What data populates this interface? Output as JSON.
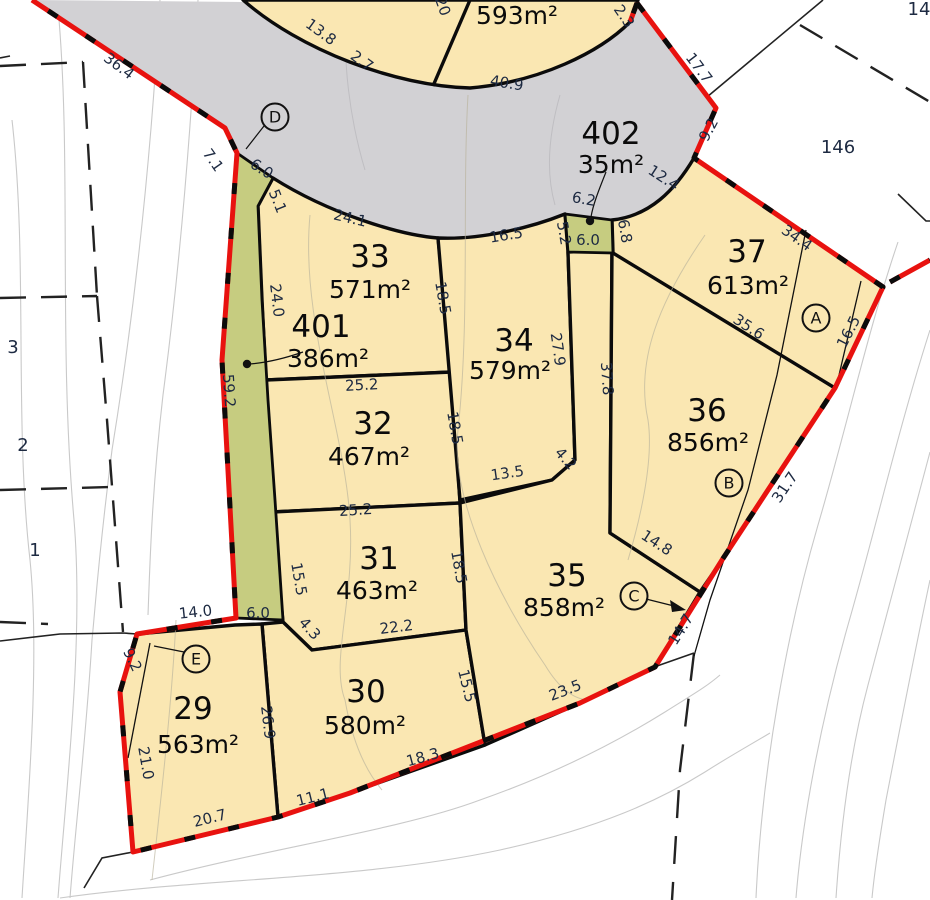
{
  "map_type": "cadastral subdivision survey plan",
  "colors": {
    "lot_fill": "#FAE7B2",
    "road_fill": "#D2D1D4",
    "reserve_fill": "#C6CC80",
    "boundary_red": "#E8120F",
    "line_black": "#0B0B0B",
    "contour_gray": "#C9C9C9",
    "dim_text": "#1D2A42"
  },
  "lots": [
    {
      "id": "33",
      "area": "571m²",
      "nx": 370,
      "ny": 267,
      "ax": 370,
      "ay": 298
    },
    {
      "id": "401",
      "area": "386m²",
      "nx": 321,
      "ny": 337,
      "ax": 328,
      "ay": 367
    },
    {
      "id": "32",
      "area": "467m²",
      "nx": 373,
      "ny": 434,
      "ax": 369,
      "ay": 465
    },
    {
      "id": "34",
      "area": "579m²",
      "nx": 514,
      "ny": 351,
      "ax": 510,
      "ay": 379
    },
    {
      "id": "31",
      "area": "463m²",
      "nx": 379,
      "ny": 569,
      "ax": 377,
      "ay": 599
    },
    {
      "id": "35",
      "area": "858m²",
      "nx": 567,
      "ny": 586,
      "ax": 564,
      "ay": 616
    },
    {
      "id": "36",
      "area": "856m²",
      "nx": 707,
      "ny": 421,
      "ax": 708,
      "ay": 451
    },
    {
      "id": "37",
      "area": "613m²",
      "nx": 747,
      "ny": 262,
      "ax": 748,
      "ay": 294
    },
    {
      "id": "30",
      "area": "580m²",
      "nx": 366,
      "ny": 702,
      "ax": 365,
      "ay": 734
    },
    {
      "id": "29",
      "area": "563m²",
      "nx": 193,
      "ny": 719,
      "ax": 198,
      "ay": 753
    },
    {
      "id": "402",
      "area": "35m²",
      "nx": 611,
      "ny": 144,
      "ax": 611,
      "ay": 173
    },
    {
      "id": "",
      "area": "593m²",
      "nx": 0,
      "ny": 0,
      "ax": 517,
      "ay": 24
    }
  ],
  "dimensions": [
    {
      "t": "36.4",
      "x": 116,
      "y": 70,
      "r": 37
    },
    {
      "t": "7.1",
      "x": 209,
      "y": 163,
      "r": 55
    },
    {
      "t": "6.0",
      "x": 259,
      "y": 173,
      "r": 33
    },
    {
      "t": "5.1",
      "x": 273,
      "y": 203,
      "r": 68
    },
    {
      "t": "24.1",
      "x": 349,
      "y": 223,
      "r": 13
    },
    {
      "t": "13.8",
      "x": 318,
      "y": 36,
      "r": 36
    },
    {
      "t": "2.7",
      "x": 359,
      "y": 65,
      "r": 36
    },
    {
      "t": "40.9",
      "x": 506,
      "y": 88,
      "r": 9
    },
    {
      "t": "20",
      "x": 438,
      "y": 8,
      "r": 70
    },
    {
      "t": "2.3",
      "x": 620,
      "y": 19,
      "r": 55
    },
    {
      "t": "17.7",
      "x": 695,
      "y": 71,
      "r": 53
    },
    {
      "t": "9.2",
      "x": 713,
      "y": 132,
      "r": -62
    },
    {
      "t": "12.4",
      "x": 661,
      "y": 182,
      "r": 33
    },
    {
      "t": "6.2",
      "x": 583,
      "y": 204,
      "r": 10
    },
    {
      "t": "5.2",
      "x": 559,
      "y": 234,
      "r": 80
    },
    {
      "t": "6.0",
      "x": 588,
      "y": 245,
      "r": 0
    },
    {
      "t": "6.8",
      "x": 620,
      "y": 232,
      "r": 80
    },
    {
      "t": "16.5",
      "x": 507,
      "y": 240,
      "r": -9
    },
    {
      "t": "34.4",
      "x": 794,
      "y": 242,
      "r": 35
    },
    {
      "t": "16.5",
      "x": 853,
      "y": 334,
      "r": -63
    },
    {
      "t": "35.6",
      "x": 746,
      "y": 331,
      "r": 33
    },
    {
      "t": "31.7",
      "x": 789,
      "y": 490,
      "r": -56
    },
    {
      "t": "14.7",
      "x": 685,
      "y": 632,
      "r": -58
    },
    {
      "t": "14.8",
      "x": 654,
      "y": 547,
      "r": 33
    },
    {
      "t": "37.8",
      "x": 602,
      "y": 379,
      "r": 86
    },
    {
      "t": "27.9",
      "x": 553,
      "y": 350,
      "r": 82
    },
    {
      "t": "4.2",
      "x": 562,
      "y": 462,
      "r": 48
    },
    {
      "t": "13.5",
      "x": 508,
      "y": 478,
      "r": -8
    },
    {
      "t": "18.5",
      "x": 438,
      "y": 299,
      "r": 80
    },
    {
      "t": "18.5",
      "x": 450,
      "y": 429,
      "r": 80
    },
    {
      "t": "18.5",
      "x": 454,
      "y": 568,
      "r": 80
    },
    {
      "t": "25.2",
      "x": 362,
      "y": 390,
      "r": -3
    },
    {
      "t": "25.2",
      "x": 356,
      "y": 515,
      "r": -4
    },
    {
      "t": "22.2",
      "x": 397,
      "y": 632,
      "r": -7
    },
    {
      "t": "4.3",
      "x": 306,
      "y": 632,
      "r": 48
    },
    {
      "t": "15.5",
      "x": 294,
      "y": 580,
      "r": 80
    },
    {
      "t": "15.5",
      "x": 462,
      "y": 687,
      "r": 76
    },
    {
      "t": "24.0",
      "x": 272,
      "y": 301,
      "r": 83
    },
    {
      "t": "59.2",
      "x": 224,
      "y": 391,
      "r": 86
    },
    {
      "t": "6.0",
      "x": 258,
      "y": 618,
      "r": 0
    },
    {
      "t": "14.0",
      "x": 196,
      "y": 617,
      "r": -6
    },
    {
      "t": "9.2",
      "x": 128,
      "y": 662,
      "r": 64
    },
    {
      "t": "21.0",
      "x": 141,
      "y": 764,
      "r": 80
    },
    {
      "t": "20.7",
      "x": 211,
      "y": 823,
      "r": -14
    },
    {
      "t": "11.1",
      "x": 314,
      "y": 802,
      "r": -14
    },
    {
      "t": "18.3",
      "x": 424,
      "y": 762,
      "r": -15
    },
    {
      "t": "23.5",
      "x": 567,
      "y": 695,
      "r": -21
    },
    {
      "t": "26.9",
      "x": 263,
      "y": 723,
      "r": 83
    }
  ],
  "adjacent_parcels": [
    {
      "t": "146",
      "x": 838,
      "y": 153
    },
    {
      "t": "14",
      "x": 919,
      "y": 15
    },
    {
      "t": "3",
      "x": 13,
      "y": 353
    },
    {
      "t": "2",
      "x": 23,
      "y": 451
    },
    {
      "t": "1",
      "x": 35,
      "y": 556
    }
  ],
  "markers": [
    {
      "t": "D",
      "x": 275,
      "y": 117
    },
    {
      "t": "A",
      "x": 816,
      "y": 318
    },
    {
      "t": "B",
      "x": 729,
      "y": 483
    },
    {
      "t": "C",
      "x": 634,
      "y": 596
    },
    {
      "t": "E",
      "x": 196,
      "y": 659
    }
  ]
}
